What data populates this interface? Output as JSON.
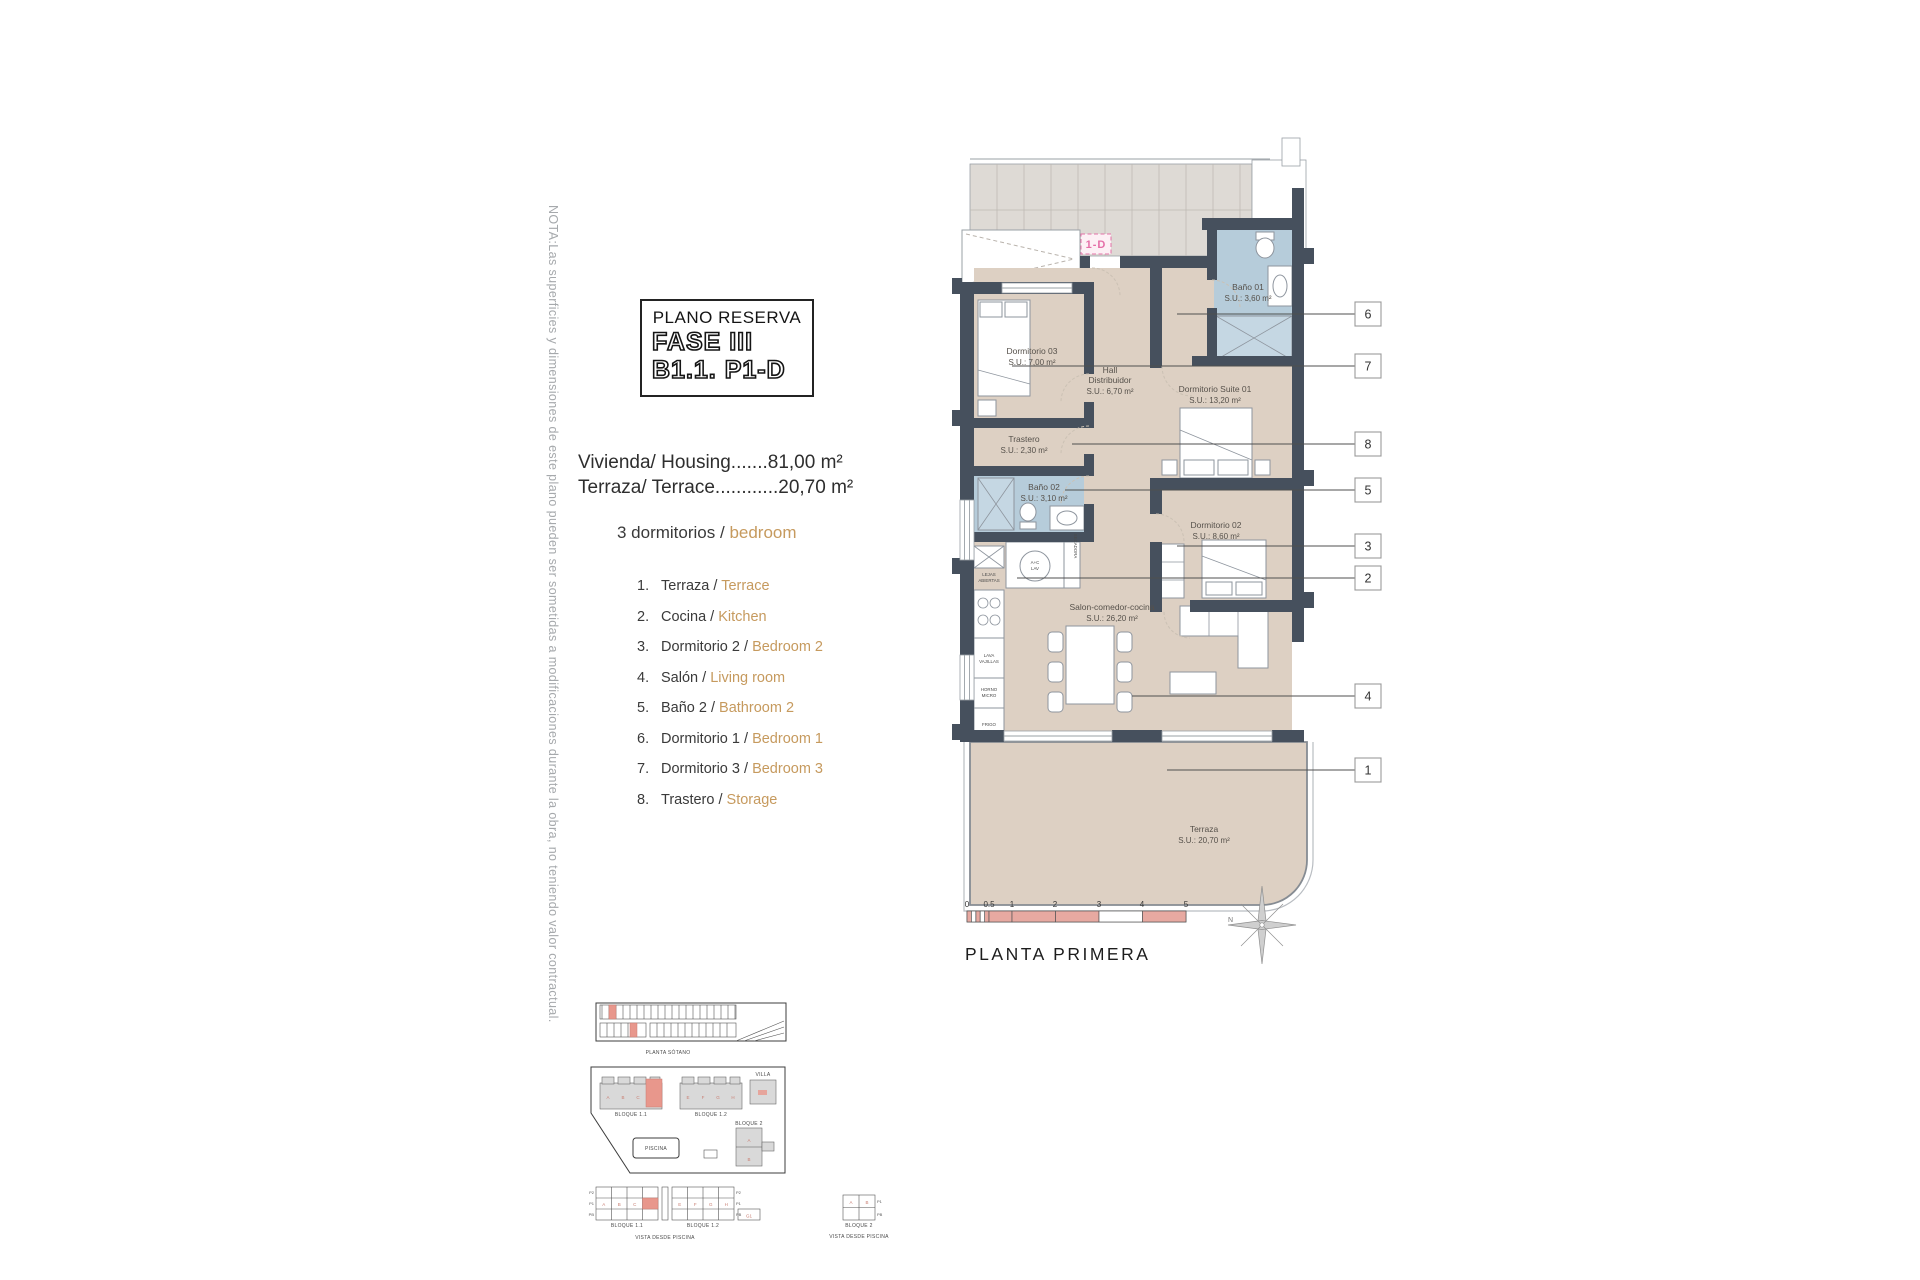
{
  "note": "NOTA:Las superficies y dimensiones de este plano pueden ser sometidas a modificaciones durante la obra, no teniendo valor contractual.",
  "title_box": {
    "kicker": "PLANO RESERVA",
    "phase": "FASE III",
    "unit": "B1.1. P1-D"
  },
  "areas": {
    "housing": "Vivienda/ Housing.......81,00 m²",
    "terrace": "Terraza/ Terrace............20,70 m²"
  },
  "bedrooms": {
    "es": "3 dormitorios /",
    "en": "bedroom"
  },
  "legend": [
    {
      "num": "1.",
      "es": "Terraza /",
      "en": "Terrace"
    },
    {
      "num": "2.",
      "es": "Cocina /",
      "en": "Kitchen"
    },
    {
      "num": "3.",
      "es": "Dormitorio 2 /",
      "en": "Bedroom 2"
    },
    {
      "num": "4.",
      "es": "Salón /",
      "en": "Living room"
    },
    {
      "num": "5.",
      "es": "Baño 2 /",
      "en": "Bathroom 2"
    },
    {
      "num": "6.",
      "es": "Dormitorio 1 /",
      "en": "Bedroom 1"
    },
    {
      "num": "7.",
      "es": "Dormitorio 3 /",
      "en": "Bedroom 3"
    },
    {
      "num": "8.",
      "es": "Trastero /",
      "en": "Storage"
    }
  ],
  "plan": {
    "unit_tag": "1-D",
    "rooms": {
      "dorm03": {
        "name": "Dormitorio 03",
        "area": "S.U.: 7,00 m²"
      },
      "bano01": {
        "name": "Baño 01",
        "area": "S.U.: 3,60 m²"
      },
      "hall": {
        "name": "Hall",
        "name2": "Distribuidor",
        "area": "S.U.: 6,70 m²"
      },
      "suite": {
        "name": "Dormitorio Suite 01",
        "area": "S.U.: 13,20 m²"
      },
      "trastero": {
        "name": "Trastero",
        "area": "S.U.: 2,30 m²"
      },
      "bano02": {
        "name": "Baño 02",
        "area": "S.U.: 3,10 m²"
      },
      "dorm02": {
        "name": "Dormitorio 02",
        "area": "S.U.: 8,60 m²"
      },
      "salon": {
        "name": "Salon-comedor-cocina",
        "area": "S.U.: 26,20 m²"
      },
      "terraza": {
        "name": "Terraza",
        "area": "S.U.: 20,70 m²"
      }
    },
    "kitchen": {
      "shelf1": "LEJAS",
      "shelf2": "ABIERTAS",
      "wash1": "A+C",
      "wash2": "LAV",
      "dryer": "SECADORA",
      "dw1": "LAVA",
      "dw2": "VAJILLAS",
      "oven1": "HORNO",
      "oven2": "MICRO",
      "fridge": "FRIGO"
    },
    "callouts": [
      "6",
      "7",
      "8",
      "5",
      "3",
      "2",
      "4",
      "1"
    ],
    "scale_ticks": [
      "0",
      "0.5",
      "1",
      "2",
      "3",
      "4",
      "5"
    ],
    "floor_label": "PLANTA PRIMERA",
    "compass": "N"
  },
  "site": {
    "garage_caption": "PLANTA SÓTANO",
    "b11": "BLOQUE 1.1",
    "b12": "BLOQUE 1.2",
    "b2": "BLOQUE 2",
    "villa": "VILLA",
    "pool": "PISCINA",
    "vista": "VISTA DESDE PISCINA",
    "g1": "G1",
    "floors": [
      "P2",
      "P1",
      "PB"
    ],
    "floors2": [
      "P1",
      "PB"
    ],
    "units_a": [
      "A",
      "B",
      "C"
    ],
    "units_b": [
      "E",
      "F",
      "G",
      "H"
    ],
    "units_b2": [
      "A",
      "B"
    ]
  },
  "colors": {
    "accent": "#c69a5e",
    "wall": "#46505d",
    "floor": "#ddd0c3",
    "bath_floor": "#b6ccda",
    "highlight_red": "#e8978c",
    "scale_pink": "#e7a9a1",
    "unit_tag_pink": "#e56fa8",
    "note_gray": "#a6a9ac"
  }
}
